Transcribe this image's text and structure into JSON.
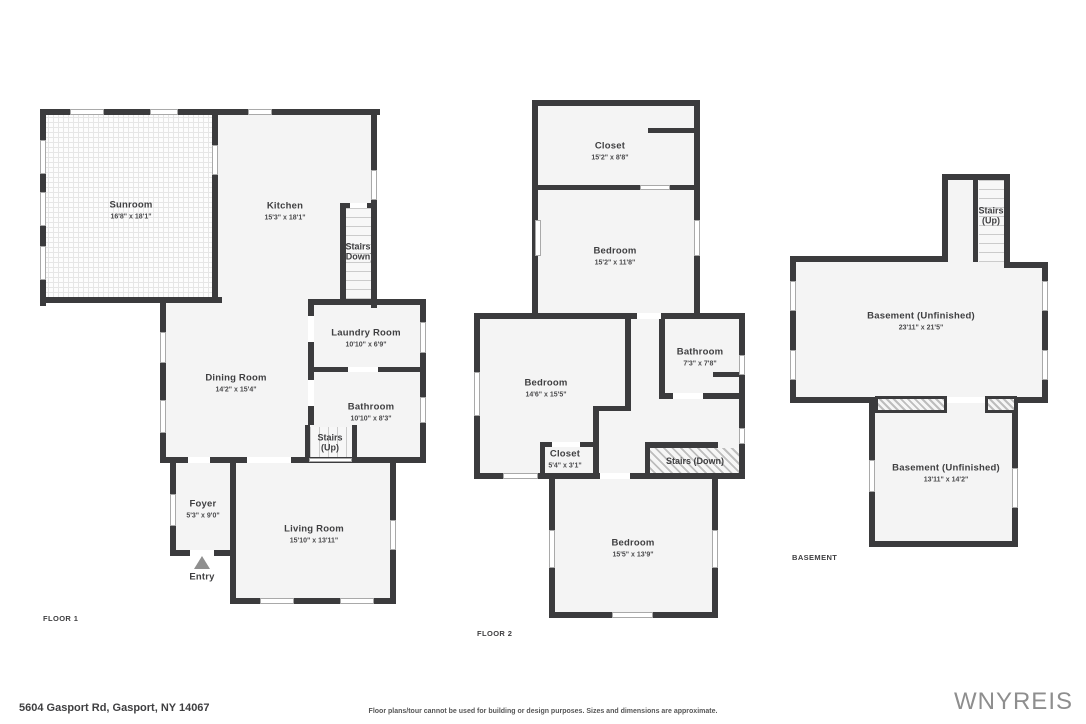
{
  "colors": {
    "wall": "#3b3b3d",
    "room_fill": "#f4f4f4",
    "label": "#3f3f41",
    "brand": "#8e8e8e"
  },
  "floor1": {
    "tag": "FLOOR 1",
    "entry": "Entry",
    "rooms": {
      "sunroom": {
        "name": "Sunroom",
        "dims": "16'8\" x 18'1\""
      },
      "kitchen": {
        "name": "Kitchen",
        "dims": "15'3\" x 18'1\""
      },
      "stairs_down": {
        "line1": "Stairs",
        "line2": "(Down)"
      },
      "laundry": {
        "name": "Laundry Room",
        "dims": "10'10\" x 6'9\""
      },
      "dining": {
        "name": "Dining Room",
        "dims": "14'2\" x 15'4\""
      },
      "bathroom": {
        "name": "Bathroom",
        "dims": "10'10\" x 8'3\""
      },
      "stairs_up": {
        "line1": "Stairs",
        "line2": "(Up)"
      },
      "foyer": {
        "name": "Foyer",
        "dims": "5'3\" x 9'0\""
      },
      "living": {
        "name": "Living Room",
        "dims": "15'10\" x 13'11\""
      }
    }
  },
  "floor2": {
    "tag": "FLOOR 2",
    "rooms": {
      "closet_top": {
        "name": "Closet",
        "dims": "15'2\" x 8'8\""
      },
      "bedroom_top": {
        "name": "Bedroom",
        "dims": "15'2\" x 11'8\""
      },
      "bedroom_mid": {
        "name": "Bedroom",
        "dims": "14'6\" x 15'5\""
      },
      "bathroom": {
        "name": "Bathroom",
        "dims": "7'3\" x 7'8\""
      },
      "closet_mid": {
        "name": "Closet",
        "dims": "5'4\" x 3'1\""
      },
      "stairs_down": {
        "name": "Stairs (Down)"
      },
      "bedroom_bottom": {
        "name": "Bedroom",
        "dims": "15'5\" x 13'9\""
      }
    }
  },
  "basement": {
    "tag": "BASEMENT",
    "rooms": {
      "stairs_up": {
        "line1": "Stairs",
        "line2": "(Up)"
      },
      "upper": {
        "name": "Basement (Unfinished)",
        "dims": "23'11\" x 21'5\""
      },
      "lower": {
        "name": "Basement (Unfinished)",
        "dims": "13'11\" x 14'2\""
      }
    }
  },
  "footer": {
    "address": "5604 Gasport Rd, Gasport, NY 14067",
    "disclaimer": "Floor plans/tour cannot be used for building or design purposes. Sizes and dimensions are approximate.",
    "brand": "WNYREIS"
  }
}
